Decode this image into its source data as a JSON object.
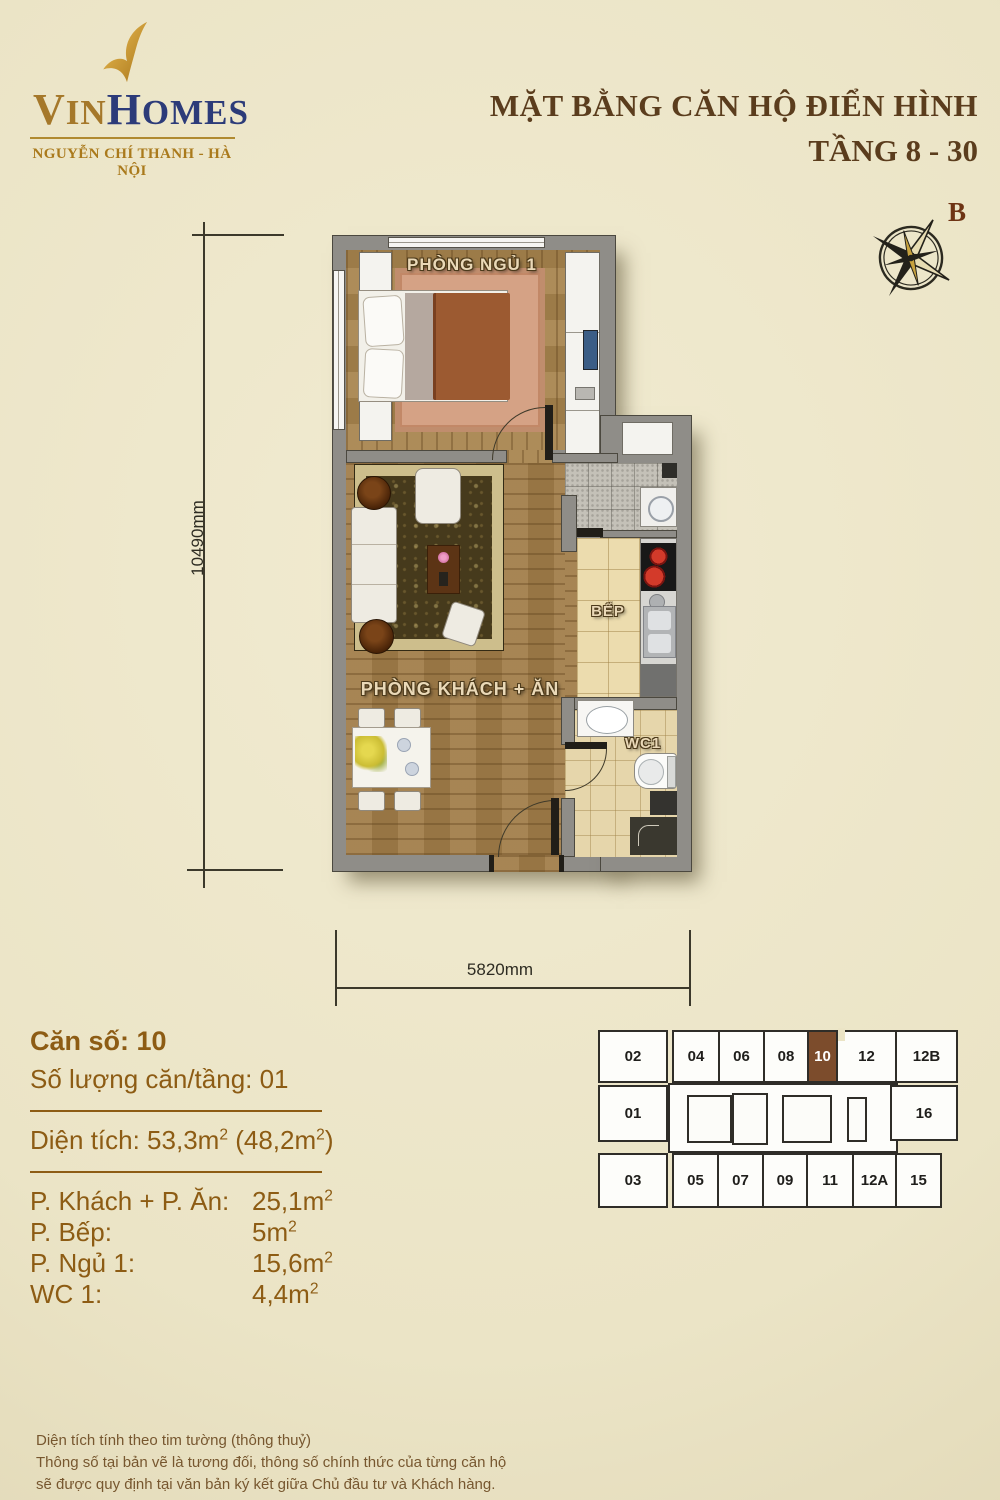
{
  "brand": {
    "part1": "V",
    "part2": "IN",
    "part3": "H",
    "part4": "OMES",
    "tagline": "NGUYỄN CHÍ THANH - HÀ NỘI"
  },
  "header": {
    "title_line1": "MẶT BẰNG CĂN HỘ ĐIỂN HÌNH",
    "title_line2": "TẦNG 8 - 30"
  },
  "compass": {
    "north_label": "B"
  },
  "plan": {
    "labels": {
      "bedroom": "PHÒNG NGỦ 1",
      "living": "PHÒNG KHÁCH + ĂN",
      "kitchen": "BẾP",
      "wc": "WC1"
    },
    "dimensions": {
      "height": "10490mm",
      "width": "5820mm"
    }
  },
  "info": {
    "unit_number": "Căn số: 10",
    "units_per_floor": "Số lượng căn/tầng: 01",
    "area_total": {
      "p1": "Diện tích: 53,3m",
      "s1": "2",
      "p2": " (48,2m",
      "s2": "2",
      "p3": ")"
    },
    "rooms": [
      {
        "label": "P. Khách + P. Ăn:",
        "value": "25,1m",
        "sup": "2"
      },
      {
        "label": "P. Bếp:",
        "value": "5m",
        "sup": "2"
      },
      {
        "label": "P. Ngủ 1:",
        "value": "15,6m",
        "sup": "2"
      },
      {
        "label": "WC 1:",
        "value": "4,4m",
        "sup": "2"
      }
    ]
  },
  "keyplan": {
    "highlighted_unit": "10",
    "top_row": [
      "02",
      "04",
      "06",
      "08",
      "10",
      "12",
      "12B"
    ],
    "middle_row": {
      "left": "01",
      "right": "16"
    },
    "bottom_row": [
      "03",
      "05",
      "07",
      "09",
      "11",
      "12A",
      "15"
    ]
  },
  "footer": {
    "line1": "Diện tích tính theo tim tường (thông thuỷ)",
    "line2": "Thông số tại bản vẽ là tương đối, thông số chính thức của từng căn hộ",
    "line3": "sẽ được quy định tại văn bản ký kết giữa Chủ đầu tư và Khách hàng."
  },
  "colors": {
    "accent_brown": "#7c4c2c",
    "text_brown": "#8d5c14",
    "title_brown": "#5b3d1d",
    "logo_gold": "#a5782a",
    "logo_navy": "#2c3b79"
  }
}
